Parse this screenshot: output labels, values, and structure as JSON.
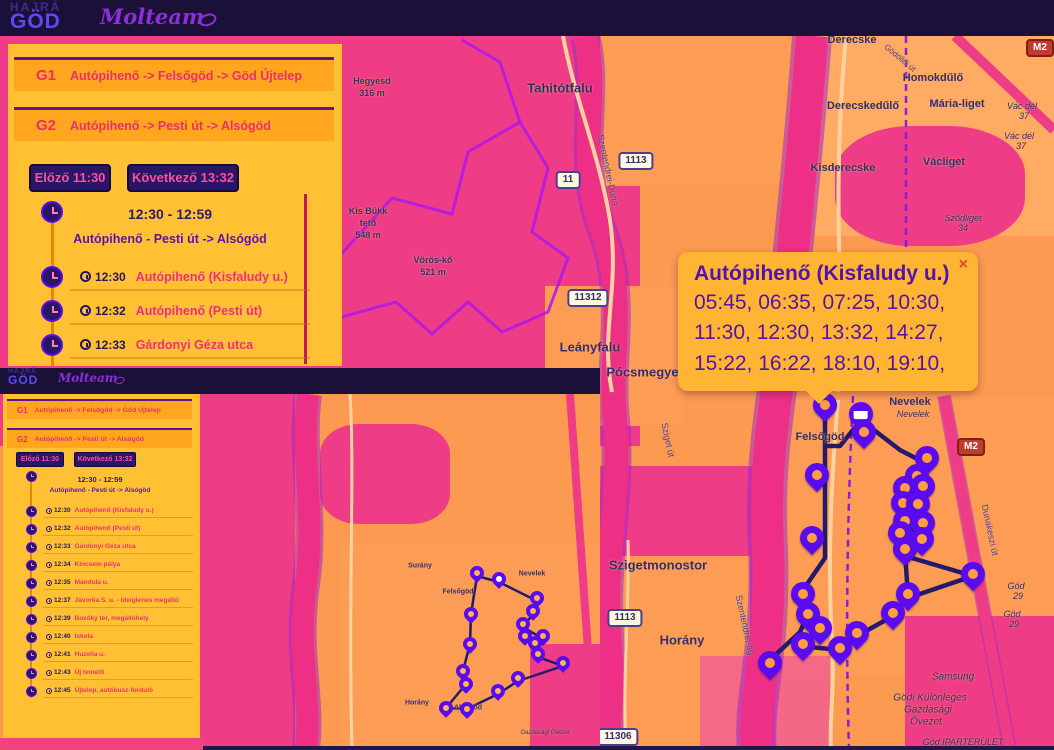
{
  "header": {
    "logo_top": "HAJRÁ",
    "logo_main": "GÖD",
    "brand": "Molteam"
  },
  "sidebar": {
    "routes": [
      {
        "code": "G1",
        "name": "Autópihenő -> Felsőgöd -> Göd Újtelep"
      },
      {
        "code": "G2",
        "name": "Autópihenő -> Pesti út -> Alsógöd"
      }
    ],
    "prev_label": "Előző 11:30",
    "next_label": "Következő 13:32",
    "trip_time_range": "12:30 - 12:59",
    "trip_name": "Autópihenő - Pesti út -> Alsógöd",
    "stops": [
      {
        "time": "12:30",
        "name": "Autópihenő (Kisfaludy u.)"
      },
      {
        "time": "12:32",
        "name": "Autópihenő (Pesti út)"
      },
      {
        "time": "12:33",
        "name": "Gárdonyi Géza utca"
      }
    ]
  },
  "mini": {
    "header": {
      "logo_top": "HAJRÁ",
      "logo_main": "GÖD",
      "brand": "Molteam"
    },
    "routes": [
      {
        "code": "G1",
        "name": "Autópihenő -> Felsőgöd -> Göd Újtelep"
      },
      {
        "code": "G2",
        "name": "Autópihenő -> Pesti út -> Alsógöd"
      }
    ],
    "prev_label": "Előző 11:30",
    "next_label": "Következő 13:32",
    "trip_time_range": "12:30 - 12:59",
    "trip_name": "Autópihenő - Pesti út -> Alsógöd",
    "stops": [
      {
        "time": "12:30",
        "name": "Autópihenő (Kisfaludy u.)"
      },
      {
        "time": "12:32",
        "name": "Autópihenő (Pesti út)"
      },
      {
        "time": "12:33",
        "name": "Gárdonyi Géza utca"
      },
      {
        "time": "12:34",
        "name": "Kincsem pálya"
      },
      {
        "time": "12:35",
        "name": "Mandula u."
      },
      {
        "time": "12:37",
        "name": "Jávorka S. u. - ideiglenes megálló"
      },
      {
        "time": "12:39",
        "name": "Bozóky tér, megállóhely"
      },
      {
        "time": "12:40",
        "name": "Iskola"
      },
      {
        "time": "12:41",
        "name": "Huzella u."
      },
      {
        "time": "12:43",
        "name": "Új temető"
      },
      {
        "time": "12:45",
        "name": "Újtelep, autóbusz-forduló"
      }
    ]
  },
  "popup": {
    "title": "Autópihenő (Kisfaludy u.)",
    "times": "05:45, 06:35, 07:25, 10:30, 11:30, 12:30, 13:32, 14:27, 15:22, 16:22, 18:10, 19:10,",
    "close": "×"
  },
  "map": {
    "labels": {
      "tahitotfalu": "Tahitótfalu",
      "hegyesd": "Hegyesd",
      "hegyesd_elev": "316 m",
      "kis_bukk": "Kis Bükk",
      "kis_bukk2": "tető",
      "kis_bukk_elev": "548 m",
      "voros_ko": "Vörös-kő",
      "voros_ko_elev": "521 m",
      "derecske": "Derecske",
      "homokdulo": "Homokdűlő",
      "maria_liget": "Mária-liget",
      "derecskedulo": "Derecskedűlő",
      "kisderecske": "Kisderecske",
      "vacliget": "Václiget",
      "szodliget": "Sződliget",
      "szodliget_num": "34",
      "vac_del": "Vác dél",
      "vac_del_num": "37",
      "leanyfalu": "Leányfalu",
      "pocsmegyer": "Pócsmegyer",
      "szigetmonostor": "Szigetmonostor",
      "horany": "Horány",
      "felsogod": "Felsőgöd",
      "nevelek": "Nevelek",
      "nevelek_it": "Nevelek",
      "samsung": "Samsung",
      "god_kulonleges": "Gödi Különleges",
      "gazdasagi": "Gazdasági",
      "ovezet": "Övezet",
      "god_ipar": "Göd IPARTERÜLET",
      "god_exit": "Göd",
      "god_exit_num": "29",
      "szentendrei_duna": "Szentendrei-Duna",
      "szentendrei_ag": "Szentendrei-ág",
      "sziget_ut": "Sziget út",
      "dunakeszi": "Dunakeszi út",
      "godolloi": "Gödöllői út"
    },
    "shields": {
      "r11": "11",
      "r1113": "1113",
      "r11312": "11312",
      "r11306": "11306",
      "m2": "M2"
    }
  },
  "mini_map": {
    "labels": {
      "surany": "Surány",
      "nevelek": "Nevelek",
      "felsogod": "Felsőgöd",
      "horany": "Horány",
      "alsogod": "Alsógöd",
      "ovezet": "Gazdasági Övezet"
    }
  },
  "colors": {
    "accent_purple": "#5314ad",
    "accent_pink": "#ee2f7c",
    "panel_yellow": "#ffc133",
    "card_orange": "#ffa61e",
    "navy": "#1b1038",
    "button_navy": "#2a1566",
    "map_orange": "#fb9a50",
    "map_magenta": "#ee3d86",
    "marker_purple": "#5a0bf0",
    "route_navy": "#231a6b"
  }
}
